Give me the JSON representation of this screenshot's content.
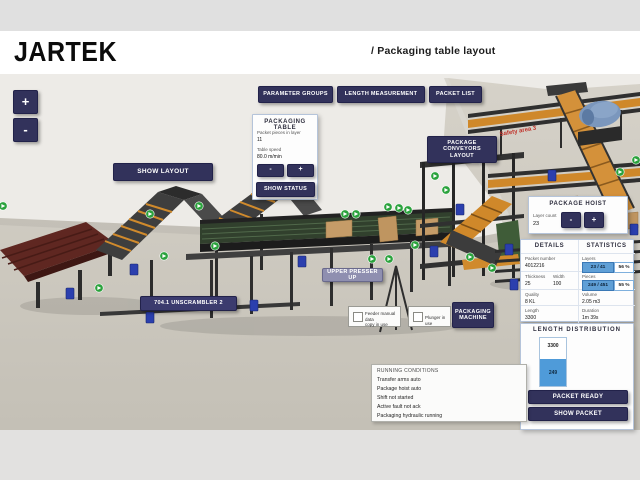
{
  "header": {
    "logo": "JARTEK",
    "title": "/ Packaging table layout"
  },
  "zoom_controls": {
    "plus": "+",
    "minus": "-"
  },
  "toolbar": {
    "parameter_groups": "PARAMETER GROUPS",
    "length_measurement": "LENGTH MEASUREMENT",
    "packet_list": "PACKET LIST"
  },
  "buttons": {
    "show_layout": "SHOW LAYOUT",
    "package_conveyors_line1": "PACKAGE CONVEYORS",
    "package_conveyors_line2": "LAYOUT",
    "upper_presser_up": "UPPER PRESSER UP",
    "unscrambler": "704.1 UNSCRAMBLER 2",
    "packaging_machine_line1": "PACKAGING",
    "packaging_machine_line2": "MACHINE",
    "packet_ready": "PACKET READY",
    "show_packet": "SHOW PACKET"
  },
  "packaging_table": {
    "title": "PACKAGING TABLE",
    "packet_pieces_label": "Packet pieces in layer",
    "packet_pieces_value": "11",
    "table_speed_label": "Table speed",
    "table_speed_value": "80.0 m/min",
    "minus": "-",
    "plus": "+",
    "show_status": "SHOW STATUS"
  },
  "package_hoist": {
    "title": "PACKAGE HOIST",
    "layer_count_label": "Layer count",
    "layer_count_value": "23",
    "minus": "-",
    "plus": "+"
  },
  "details": {
    "title": "DETAILS",
    "packet_number_label": "Packet number",
    "packet_number": "4012216",
    "thickness_label": "Thickness",
    "thickness": "25",
    "width_label": "Width",
    "width": "100",
    "quality_label": "Quality",
    "quality": "8 KL",
    "length_label": "Length",
    "length": "3300"
  },
  "statistics": {
    "title": "STATISTICS",
    "layers_label": "Layers",
    "layers_value": "23 / 41",
    "layers_pct": "56 %",
    "pieces_label": "Pieces",
    "pieces_value": "249 / 451",
    "pieces_pct": "55 %",
    "volume_label": "Volume",
    "volume": "2.05 m3",
    "duration_label": "Duration",
    "duration": "1m 39s"
  },
  "length_distribution": {
    "title": "LENGTH DISTRIBUTION",
    "bar_length_label": "3300",
    "bar_count_label": "249"
  },
  "chart_data": {
    "type": "bar",
    "title": "LENGTH DISTRIBUTION",
    "categories": [
      "3300"
    ],
    "values": [
      249
    ],
    "ylim": [
      0,
      451
    ],
    "grid": false,
    "legend": "none"
  },
  "checkboxes": {
    "feeder_line1": "Feeder manual data",
    "feeder_line2": "copy in use",
    "feeder_checked": false,
    "plunger_label": "Plunger in use",
    "plunger_checked": false
  },
  "running_conditions": {
    "title": "RUNNING CONDITIONS",
    "items": [
      "Transfer arms auto",
      "Package hoist auto",
      "Shift not started",
      "Active fault not ack",
      "Packaging hydraulic running"
    ]
  },
  "scene": {
    "safety_label": "Safety area 3"
  },
  "colors": {
    "accent_navy": "#32325b",
    "panel_border": "#b5c4da",
    "stat_blue": "#5f9fd6",
    "bar_blue": "#4f9bd9",
    "marker_green": "#2aa23c",
    "motor_blue": "#2b3fae",
    "conveyor_orange": "#cf882a",
    "infeed_maroon": "#5f2721",
    "safety_red": "#c03028"
  }
}
